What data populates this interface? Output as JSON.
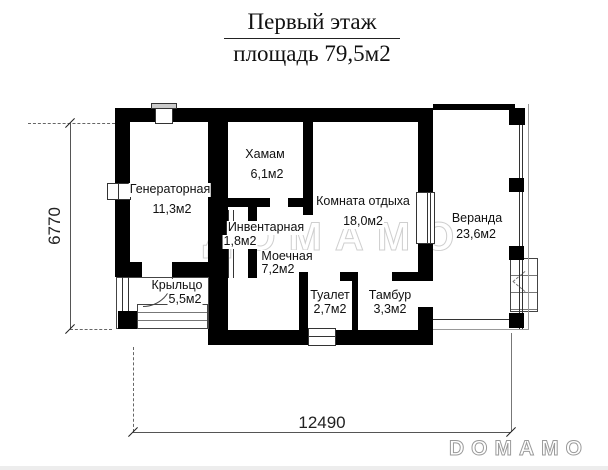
{
  "title": {
    "line1": "Первый этаж",
    "line2": "площадь 79,5м2"
  },
  "rooms": [
    {
      "name": "Генераторная",
      "area": "11,3м2"
    },
    {
      "name": "Хамам",
      "area": "6,1м2"
    },
    {
      "name": "Комната отдыха",
      "area": "18,0м2"
    },
    {
      "name": "Веранда",
      "area": "23,6м2"
    },
    {
      "name": "Инвентарная",
      "area": "1,8м2"
    },
    {
      "name": "Моечная",
      "area": "7,2м2"
    },
    {
      "name": "Крыльцо",
      "area": "5,5м2"
    },
    {
      "name": "Туалет",
      "area": "2,7м2"
    },
    {
      "name": "Тамбур",
      "area": "3,3м2"
    }
  ],
  "dimensions": {
    "horizontal": "12490",
    "vertical": "6770"
  },
  "watermark": "ДОМАМО",
  "logo": "DOMAMO",
  "colors": {
    "wall": "#000000",
    "dimension": "#555555",
    "watermark_outline": "#cfcfcf",
    "logo_outline": "#9a9a9a"
  }
}
